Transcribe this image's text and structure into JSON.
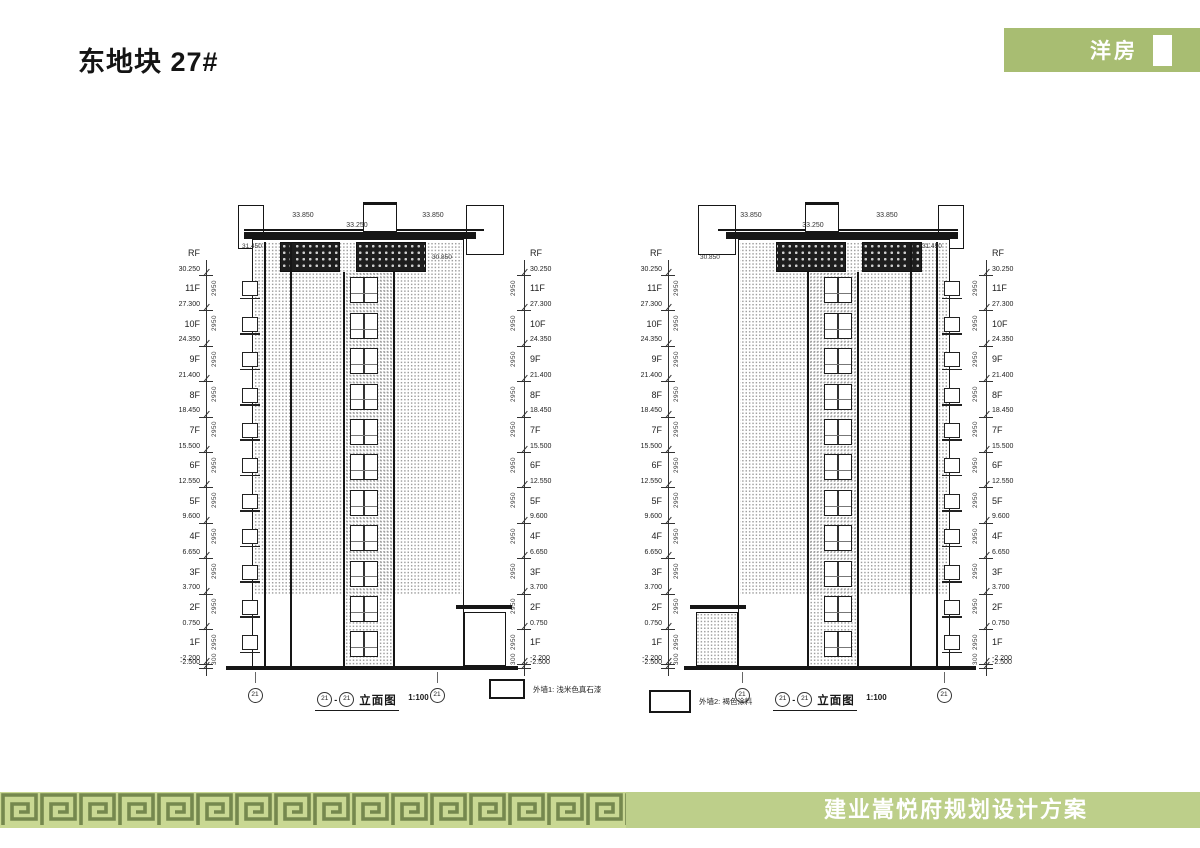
{
  "header": {
    "title": "东地块 27#",
    "badge_label": "洋房"
  },
  "footer": {
    "project_title": "建业嵩悦府规划设计方案"
  },
  "levels": [
    {
      "floor": "RF",
      "elev": "30.250"
    },
    {
      "floor": "11F",
      "elev": "27.300"
    },
    {
      "floor": "10F",
      "elev": "24.350"
    },
    {
      "floor": "9F",
      "elev": "21.400"
    },
    {
      "floor": "8F",
      "elev": "18.450"
    },
    {
      "floor": "7F",
      "elev": "15.500"
    },
    {
      "floor": "6F",
      "elev": "12.550"
    },
    {
      "floor": "5F",
      "elev": "9.600"
    },
    {
      "floor": "4F",
      "elev": "6.650"
    },
    {
      "floor": "3F",
      "elev": "3.700"
    },
    {
      "floor": "2F",
      "elev": "0.750"
    },
    {
      "floor": "1F",
      "elev": "-2.200"
    },
    {
      "floor": "",
      "elev": "-2.500"
    }
  ],
  "dims": {
    "floor_height": "2950"
  },
  "drawings": [
    {
      "axis_left": "21",
      "axis_right": "21",
      "separator": "-",
      "caption": "立面图",
      "scale_text": "1:100",
      "top_dims": [
        "33.850",
        "33.250",
        "33.850"
      ],
      "side_elev_left": "31.450",
      "side_elev_right": "30.850"
    },
    {
      "axis_left": "21",
      "axis_right": "21",
      "separator": "-",
      "caption": "立面图",
      "scale_text": "1:100",
      "top_dims": [
        "33.850",
        "33.250",
        "33.850"
      ],
      "side_elev_left": "30.850",
      "side_elev_right": "31.450"
    }
  ],
  "legends": [
    {
      "label": "外墙1: 浅米色真石漆"
    },
    {
      "label": "外墙2: 褐色涂料"
    }
  ],
  "colors": {
    "badge_green": "#a8bd72",
    "bar_green": "#bdcf8a",
    "meander_light": "#c9d893",
    "meander_dark": "#75884e",
    "line_dark": "#161616"
  }
}
